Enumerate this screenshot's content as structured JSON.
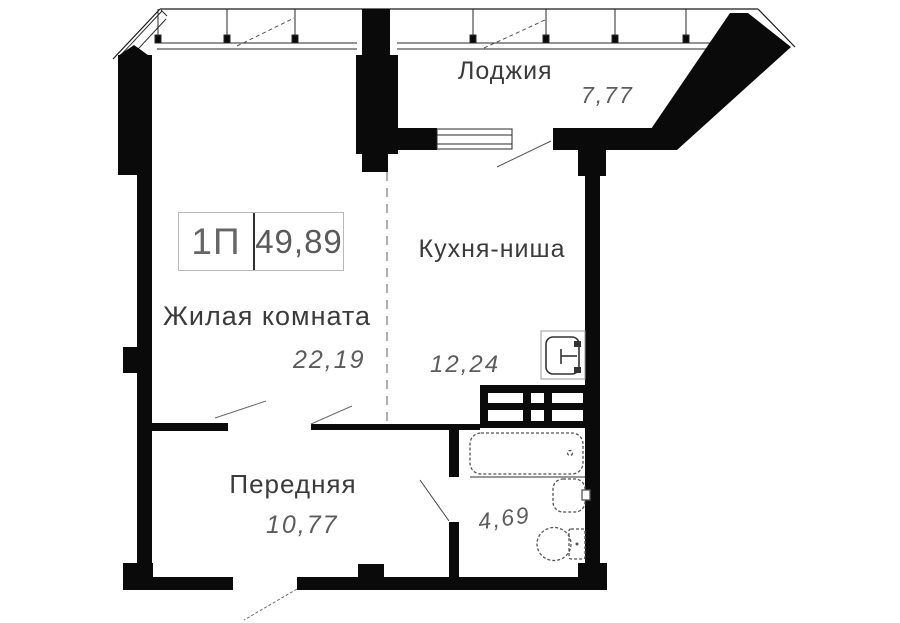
{
  "plan": {
    "type_label": "1П",
    "total_area": "49,89",
    "rooms": [
      {
        "id": "loggia",
        "name": "Лоджия",
        "area": "7,77"
      },
      {
        "id": "living",
        "name": "Жилая комната",
        "area": "22,19"
      },
      {
        "id": "kitchen",
        "name": "Кухня-ниша",
        "area": "12,24"
      },
      {
        "id": "hall",
        "name": "Передняя",
        "area": "10,77"
      },
      {
        "id": "bathroom",
        "name": "",
        "area": "4,69"
      }
    ],
    "colors": {
      "wall": "#0a0a0a",
      "background": "#ffffff",
      "label_text": "#3b3b3b",
      "area_text": "#5c5c5c",
      "box_border": "#b8b8b8",
      "dashed_partition": "#999999",
      "fixture_stroke": "#555555"
    }
  }
}
